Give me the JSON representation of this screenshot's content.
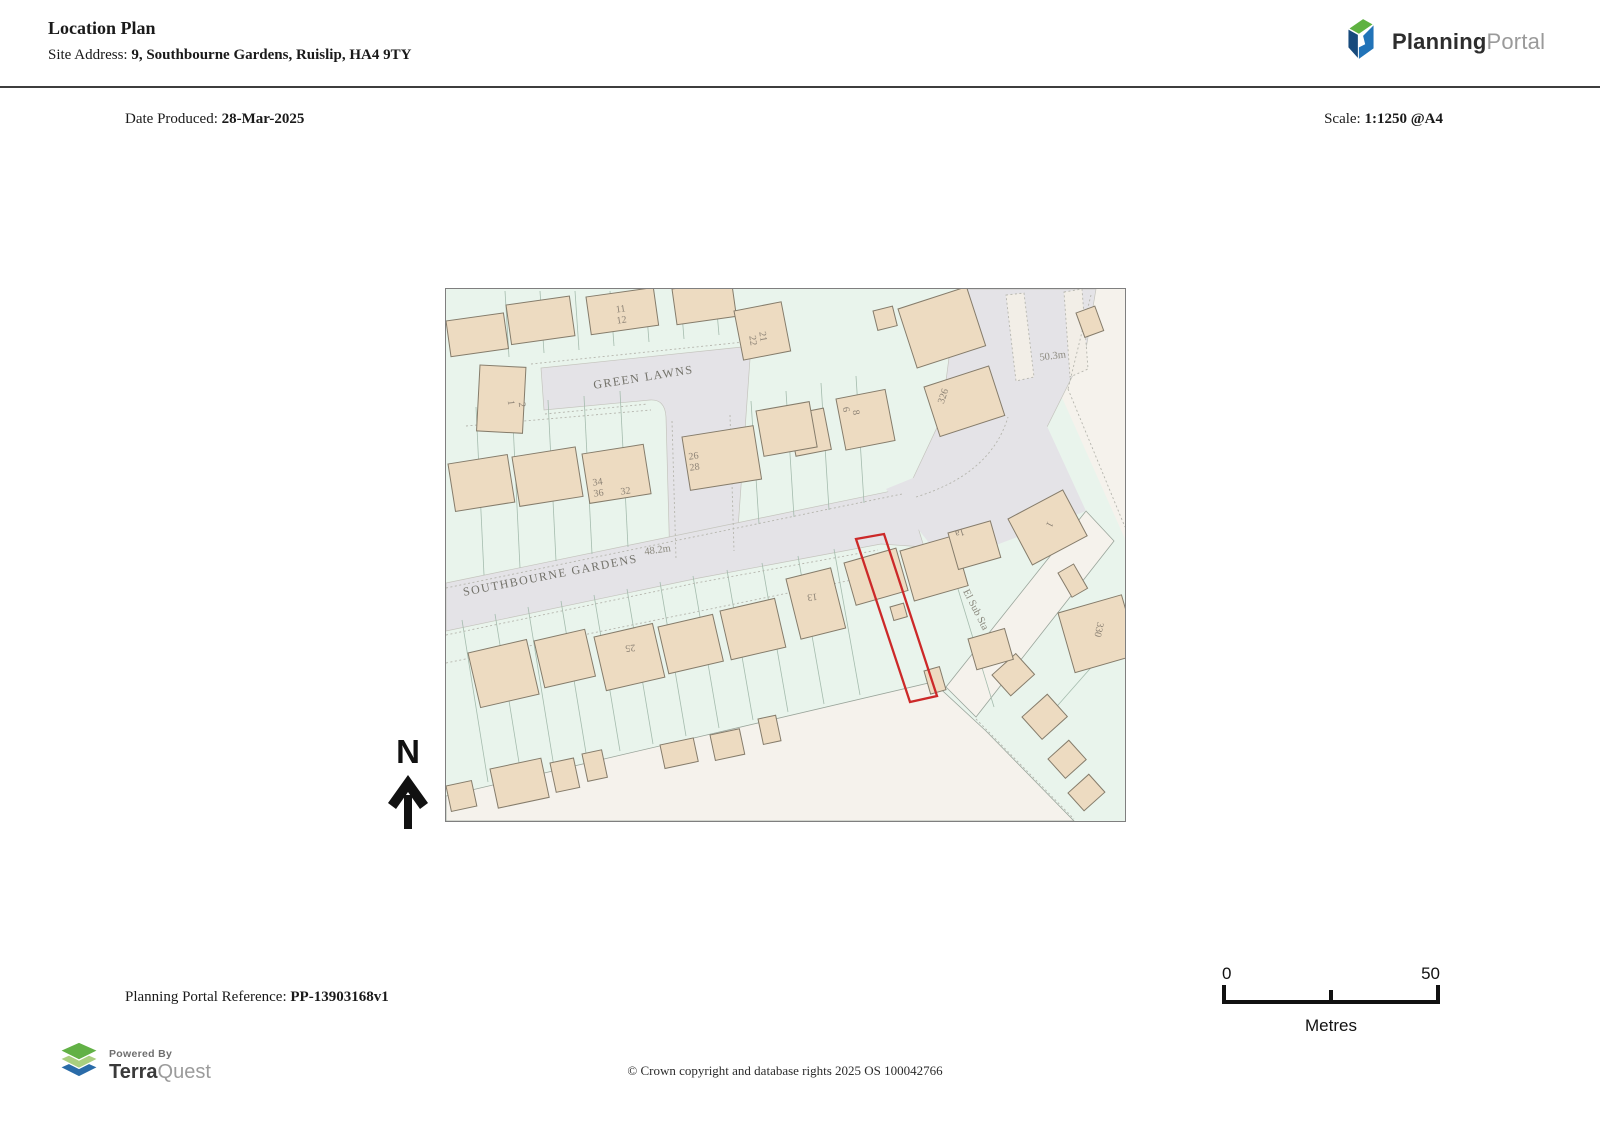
{
  "header": {
    "title": "Location Plan",
    "site_address_label": "Site Address: ",
    "site_address": "9, Southbourne Gardens, Ruislip, HA4 9TY",
    "logo": {
      "brand_bold": "Planning",
      "brand_light": "Portal"
    }
  },
  "meta": {
    "date_label": "Date Produced: ",
    "date": "28-Mar-2025",
    "scale_label": "Scale: ",
    "scale": "1:1250 @A4"
  },
  "map": {
    "site_outline_color": "#cc2929",
    "labels": [
      {
        "text": "GREEN LAWNS"
      },
      {
        "text": "SOUTHBOURNE GARDENS"
      },
      {
        "text": "48.2m"
      },
      {
        "text": "50.3m"
      },
      {
        "text": "El Sub Sta"
      },
      {
        "text": "11"
      },
      {
        "text": "12"
      },
      {
        "text": "21"
      },
      {
        "text": "22"
      },
      {
        "text": "1"
      },
      {
        "text": "2"
      },
      {
        "text": "34"
      },
      {
        "text": "36"
      },
      {
        "text": "32"
      },
      {
        "text": "26"
      },
      {
        "text": "28"
      },
      {
        "text": "6"
      },
      {
        "text": "8"
      },
      {
        "text": "326"
      },
      {
        "text": "1a"
      },
      {
        "text": "1"
      },
      {
        "text": "25"
      },
      {
        "text": "13"
      },
      {
        "text": "330"
      }
    ]
  },
  "north_indicator": {
    "label": "N"
  },
  "scale_bar": {
    "start": "0",
    "end": "50",
    "unit": "Metres"
  },
  "footer": {
    "reference_label": "Planning Portal Reference: ",
    "reference": "PP-13903168v1",
    "copyright": "© Crown copyright and database rights 2025 OS 100042766",
    "terraquest": {
      "powered_by": "Powered By",
      "brand_bold": "Terra",
      "brand_light": "Quest"
    }
  }
}
